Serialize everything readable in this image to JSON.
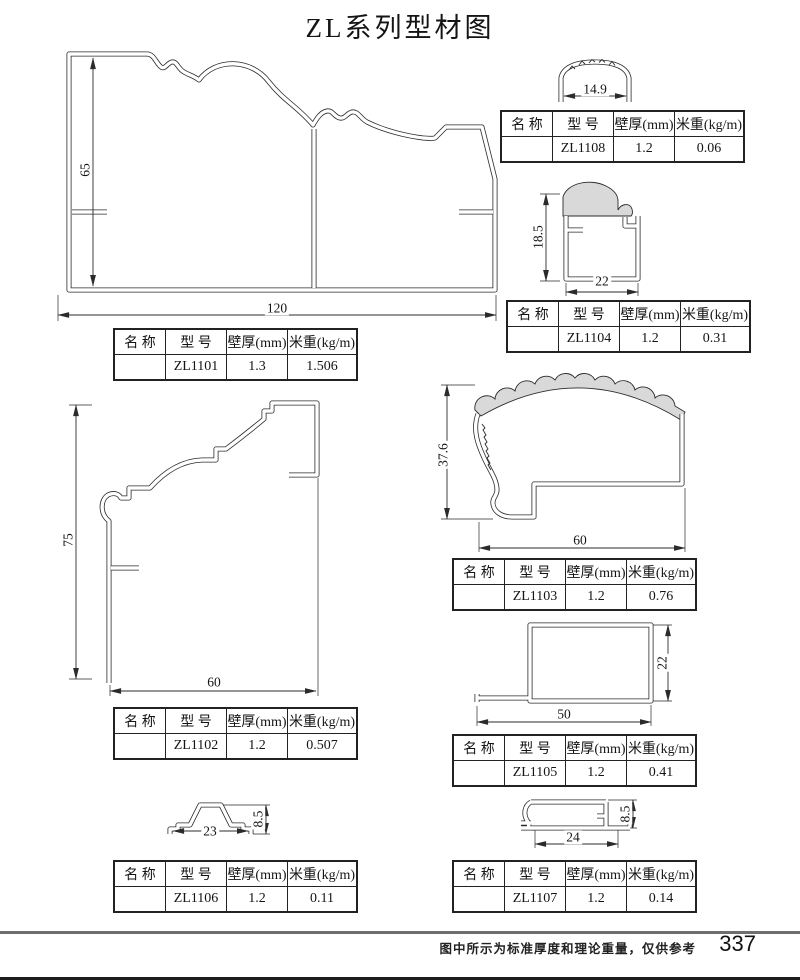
{
  "page": {
    "title": "ZL系列型材图",
    "footer_note": "图中所示为标准厚度和理论重量，仅供参考",
    "page_number": "337"
  },
  "table_headers": {
    "name": "名 称",
    "model": "型 号",
    "thickness": "壁厚(mm)",
    "weight": "米重(kg/m)"
  },
  "profiles": [
    {
      "model": "ZL1101",
      "name": "",
      "thickness": "1.3",
      "weight": "1.506",
      "dim_height": "65",
      "dim_width": "120"
    },
    {
      "model": "ZL1108",
      "name": "",
      "thickness": "1.2",
      "weight": "0.06",
      "dim_width": "14.9"
    },
    {
      "model": "ZL1104",
      "name": "",
      "thickness": "1.2",
      "weight": "0.31",
      "dim_height": "18.5",
      "dim_width": "22"
    },
    {
      "model": "ZL1102",
      "name": "",
      "thickness": "1.2",
      "weight": "0.507",
      "dim_height": "75",
      "dim_width": "60"
    },
    {
      "model": "ZL1103",
      "name": "",
      "thickness": "1.2",
      "weight": "0.76",
      "dim_height": "37.6",
      "dim_width": "60"
    },
    {
      "model": "ZL1105",
      "name": "",
      "thickness": "1.2",
      "weight": "0.41",
      "dim_height": "22",
      "dim_width": "50"
    },
    {
      "model": "ZL1106",
      "name": "",
      "thickness": "1.2",
      "weight": "0.11",
      "dim_height": "8.5",
      "dim_width": "23"
    },
    {
      "model": "ZL1107",
      "name": "",
      "thickness": "1.2",
      "weight": "0.14",
      "dim_height": "8.5",
      "dim_width": "24"
    }
  ],
  "colors": {
    "line": "#2b2b2b",
    "shade": "#d9d9d9",
    "footer_rule": "#6e6e6e"
  }
}
